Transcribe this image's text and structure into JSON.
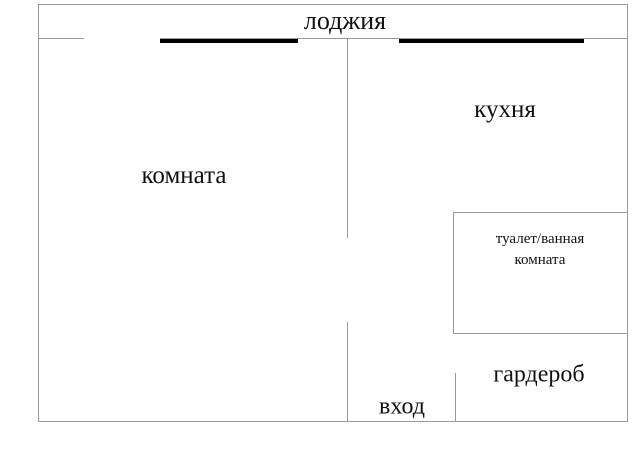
{
  "floorplan": {
    "type": "apartment-floor-plan",
    "labels": {
      "loggia": "лоджия",
      "room": "комната",
      "kitchen": "кухня",
      "bathroom_line1": "туалет/ванная",
      "bathroom_line2": "комната",
      "wardrobe": "гардероб",
      "entrance": "вход"
    },
    "colors": {
      "wall": "#9a9a9a",
      "window_bar": "#000000",
      "text": "#111111",
      "background": "#ffffff"
    }
  }
}
